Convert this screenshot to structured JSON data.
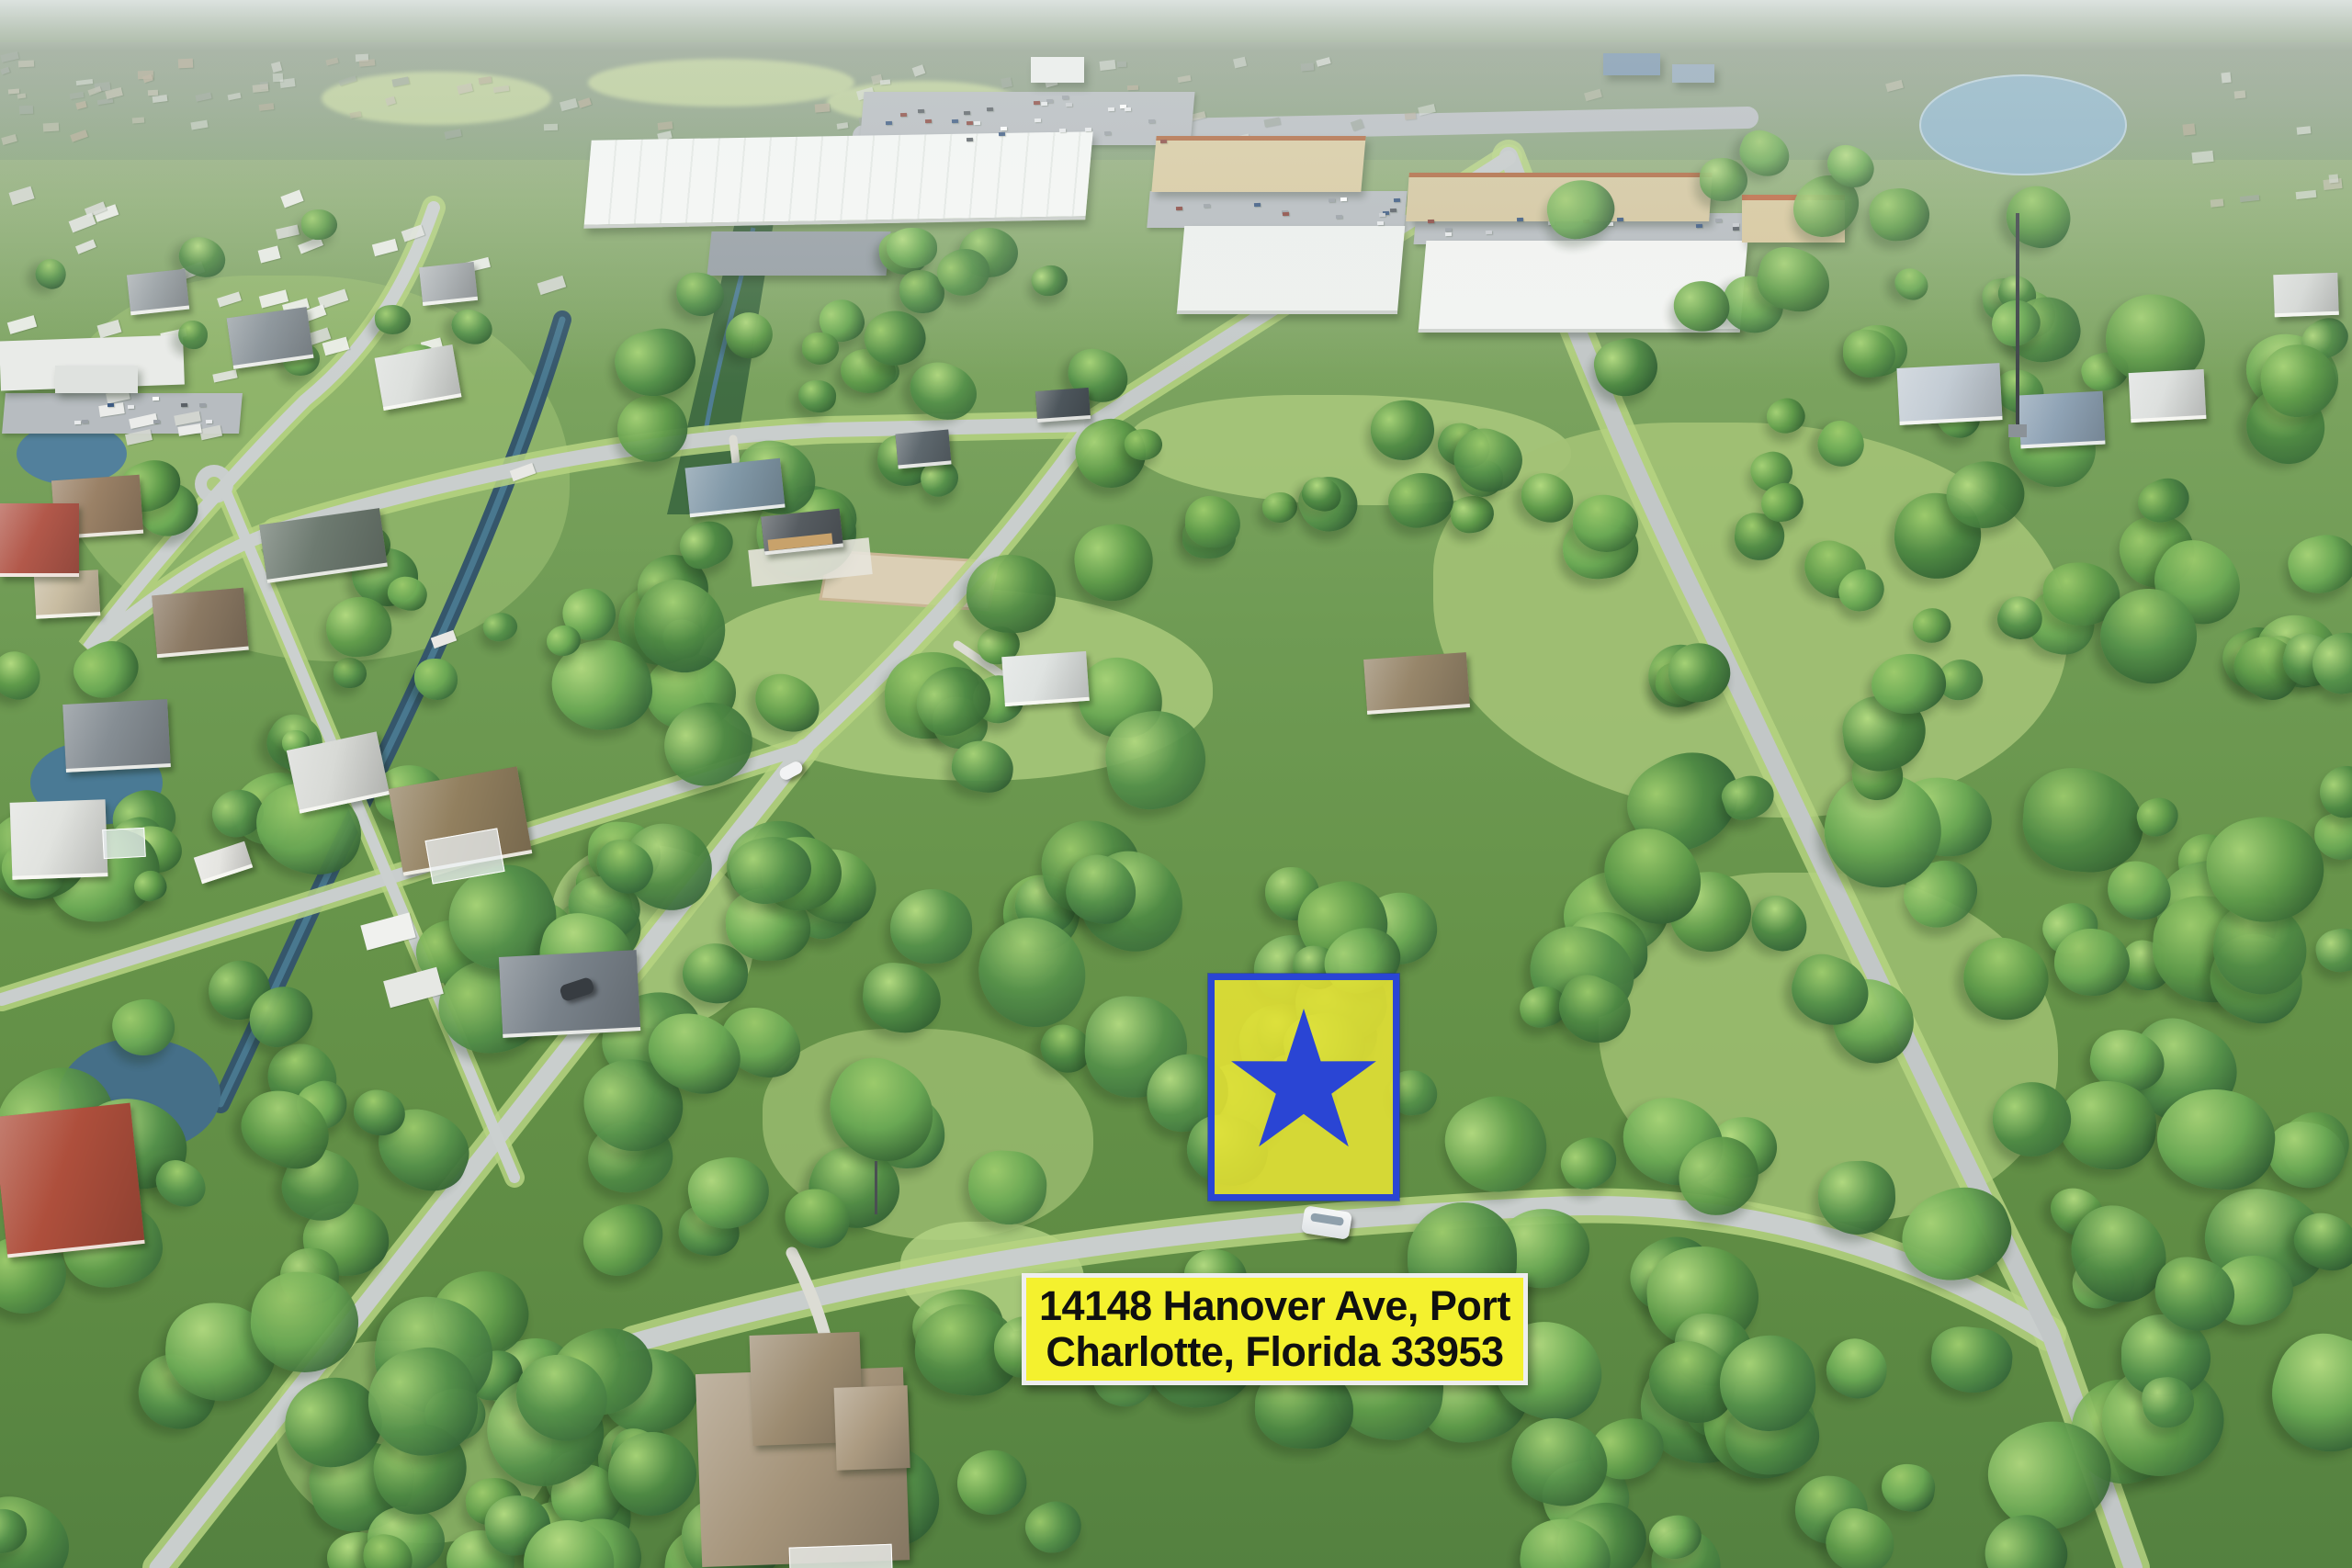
{
  "image": {
    "kind": "aerial-drone-photo",
    "caption": "Aerial view of a wooded residential area with a highlighted vacant lot, Port Charlotte, Florida"
  },
  "address_label": {
    "line1": "14148 Hanover Ave, Port",
    "line2": "Charlotte, Florida 33953",
    "background": "#f4f12e",
    "text_color": "#101010",
    "border_color": "#eeeeee"
  },
  "lot_marker": {
    "fill": "rgba(233,228,45,0.78)",
    "border_color": "#2a45d4",
    "star_color": "#2a45d4",
    "underlay": "rgba(198,212,110,0.45)"
  },
  "vehicles": {
    "white_car": "#f6f8f8",
    "windshield": "#8fa0ac",
    "dark_suv": "#373c41",
    "small_car": "#f2f3f4"
  },
  "palette": {
    "road": "#c9cecd",
    "road_dark": "#c2c7c7",
    "verge": "#b6d381",
    "water_canal": "#35566b",
    "water_canal_lite": "#49788f",
    "water_pond": "#4a7a95",
    "water_lake": "#8fb4c6",
    "sand": "#dbcfb5",
    "sand_edge": "#c9b694",
    "drainage": "#33603c",
    "creek": "#4f7d93",
    "tree_hi": [
      "#a5d276",
      "#9ccb6c",
      "#b2da80"
    ],
    "tree_mid": [
      "#5f9b4a",
      "#55914a",
      "#6aa854",
      "#4f8a44"
    ],
    "tree_dark": [
      "#2f5c30",
      "#305f36",
      "#3a6b3a",
      "#2b5630"
    ],
    "distant_specks": [
      "#d8dcd6",
      "#cfd3cb",
      "#c2bfae",
      "#b5aa94",
      "#9aa49a"
    ],
    "mobile_homes": [
      "#f0f1ee",
      "#e2e4e0",
      "#d5d8d2"
    ],
    "car_specks": [
      "#ffffff",
      "#e8eaec",
      "#c9ccd0",
      "#9aa0a6",
      "#5a6066",
      "#8c4b43",
      "#3d5a82"
    ]
  }
}
